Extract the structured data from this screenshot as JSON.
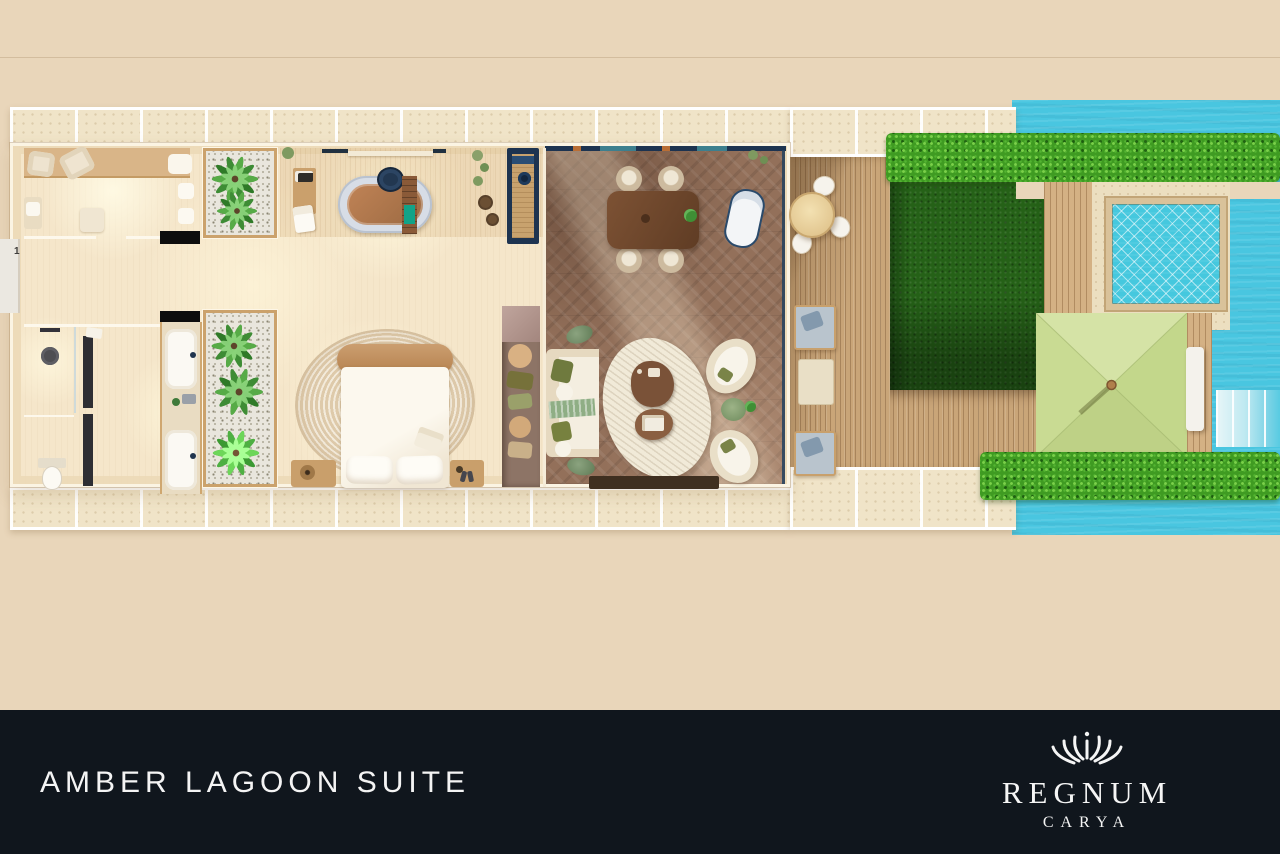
{
  "footer": {
    "title": "AMBER LAGOON SUITE",
    "brand": {
      "name": "REGNUM",
      "sub": "CARYA",
      "icon": "crown-icon"
    }
  },
  "plan": {
    "entry_number": "1"
  },
  "areas": [
    "dressing-room",
    "bathroom",
    "kitchenette-bar",
    "living-room",
    "dining-area",
    "bedroom",
    "shower-room",
    "wc",
    "double-vanity",
    "palm-courtyard-top",
    "palm-courtyard-bottom",
    "outdoor-deck",
    "garden-lawn",
    "plunge-pool",
    "pergola-daybed",
    "lagoon-pool",
    "sun-steps"
  ],
  "palette": {
    "background": "#e9d6ba",
    "water": "#49c6e0",
    "pool_water": "#45c8de",
    "grass": "#256117",
    "hedge": "#3f9b22",
    "deck_wood": "#c9a578",
    "pergola_canopy": "#cbdd97",
    "living_floor": "#93705a",
    "plan_floor": "#f5e6ca",
    "accent_navy": "#1d3350",
    "footer_background": "#10161d",
    "text": "#f4f4f4"
  }
}
